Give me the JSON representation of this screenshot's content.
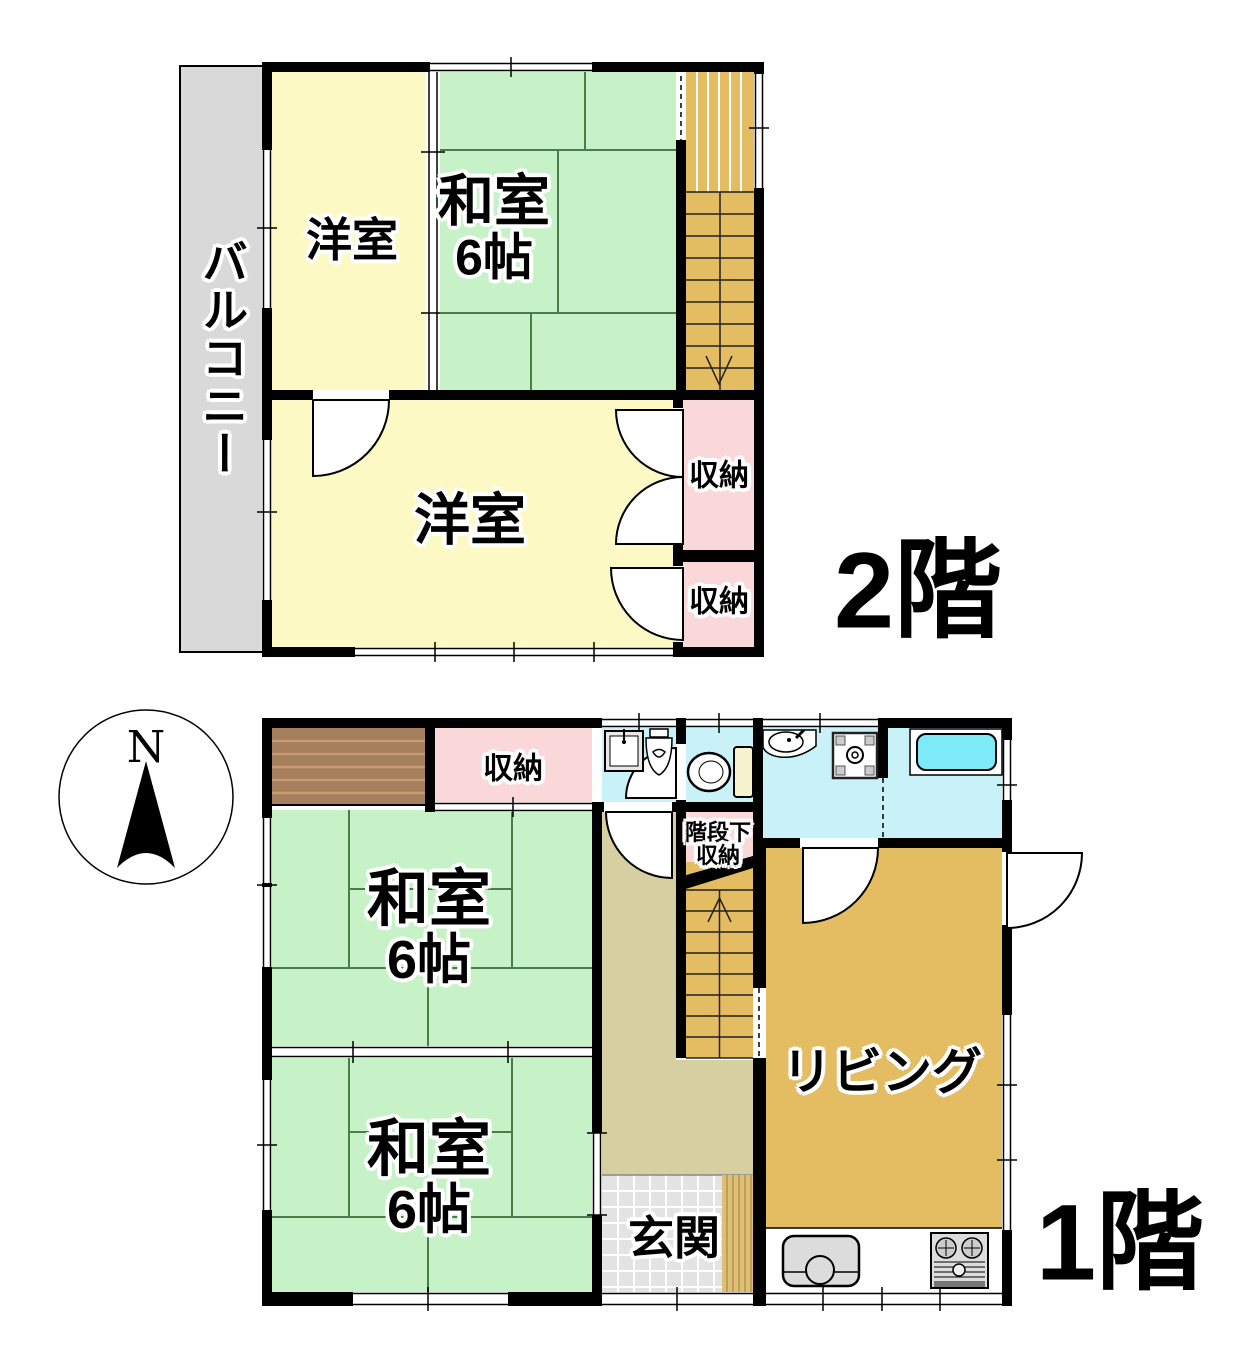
{
  "palette": {
    "wall": "#000000",
    "tatami_green": "#c7f2c7",
    "tatami_line": "#4a7d4a",
    "western_yellow": "#fdf9c4",
    "closet_pink": "#fad7d9",
    "wet_cyan": "#c9f1f8",
    "tub_cyan": "#7deaf7",
    "wood_tan": "#e4bc62",
    "hall_khaki": "#d6cfa2",
    "tile_gray": "#e3e3e3",
    "step_wood": "#debf75",
    "closet_brown": "#a6805c",
    "balcony_gray": "#d9d9d9"
  },
  "floor2": {
    "floor_label": "2階",
    "balcony_label": "バルコニー",
    "western_room_top_label": "洋室",
    "japanese_room_label_line1": "和室",
    "japanese_room_label_line2": "6帖",
    "western_room_bottom_label": "洋室",
    "closet_upper_label": "収納",
    "closet_lower_label": "収納"
  },
  "floor1": {
    "floor_label": "1階",
    "closet_label": "収納",
    "japanese_room_top_label_line1": "和室",
    "japanese_room_top_label_line2": "6帖",
    "japanese_room_bottom_label_line1": "和室",
    "japanese_room_bottom_label_line2": "6帖",
    "under_stairs_label_line1": "階段下",
    "under_stairs_label_line2": "収納",
    "living_label": "リビング",
    "entrance_label": "玄関"
  },
  "compass": {
    "north_label": "N"
  }
}
